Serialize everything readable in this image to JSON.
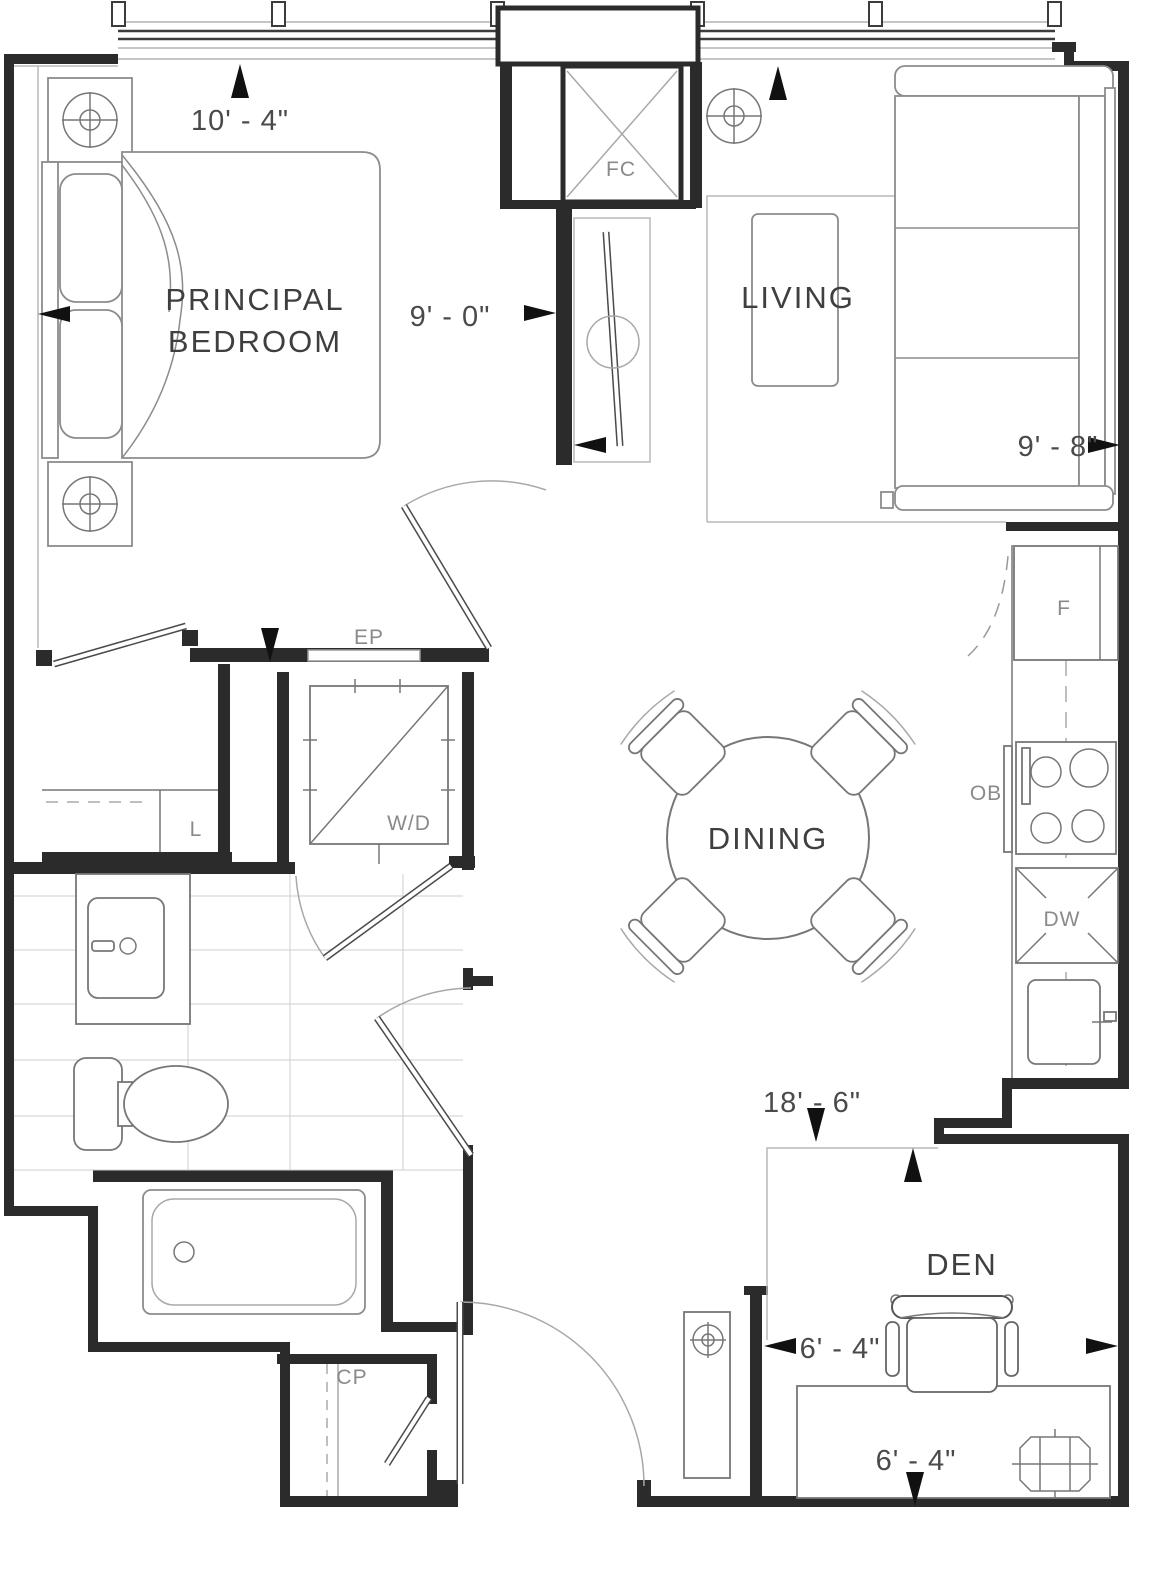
{
  "rooms": {
    "bedroom": {
      "line1": "PRINCIPAL",
      "line2": "BEDROOM"
    },
    "living": "LIVING",
    "dining": "DINING",
    "den": "DEN"
  },
  "fixtures": {
    "fan_coil": "FC",
    "electrical_panel": "EP",
    "washer_dryer": "W/D",
    "linen": "L",
    "fridge": "F",
    "oven_below": "OB",
    "dishwasher": "DW",
    "coat_closet": "CP"
  },
  "dimensions": {
    "bedroom_width": "10' - 4\"",
    "bedroom_depth": "9' - 0\"",
    "living_width": "9' - 8\"",
    "unit_depth": "18' - 6\"",
    "den_width": "6' - 4\"",
    "den_depth": "6' - 4\""
  }
}
